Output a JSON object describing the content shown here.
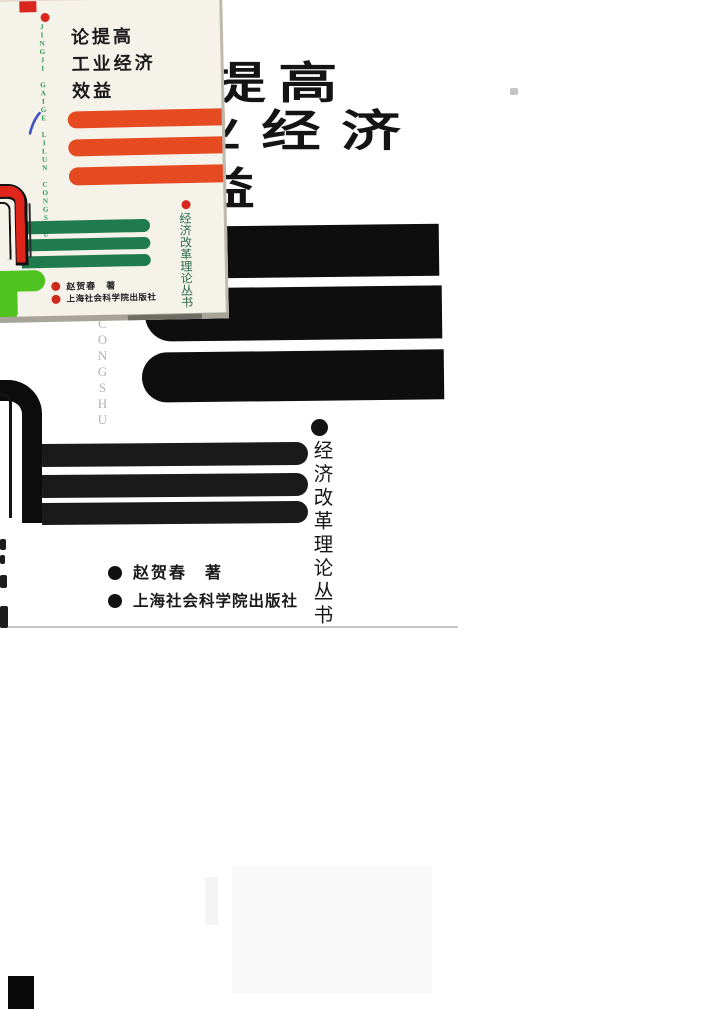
{
  "cover": {
    "title": "论提高工业经济效益",
    "title_lines": [
      "论提高",
      "工业经济",
      "效益"
    ],
    "series": "经济改革理论丛书",
    "series_romanized_tail": "CONGSHU",
    "author": "赵贺春　著",
    "publisher": "上海社会科学院出版社"
  },
  "inset": {
    "title_lines": [
      "论提高",
      "工业经济",
      "效益"
    ],
    "series_romanized": "JINGJI GAIGE LILUN CONGSHU",
    "series": "经济改革理论丛书",
    "author": "赵贺春　著",
    "publisher": "上海社会科学院出版社"
  },
  "colors": {
    "ink": "#141414",
    "accent_red": "#d8271c",
    "orange_bar": "#e54a20",
    "dark_green_bar": "#1f7b4c",
    "bright_green": "#4fc31f",
    "series_green": "#2f9b55",
    "blue_pen": "#3e52c0",
    "paper": "#f5f2ea"
  }
}
